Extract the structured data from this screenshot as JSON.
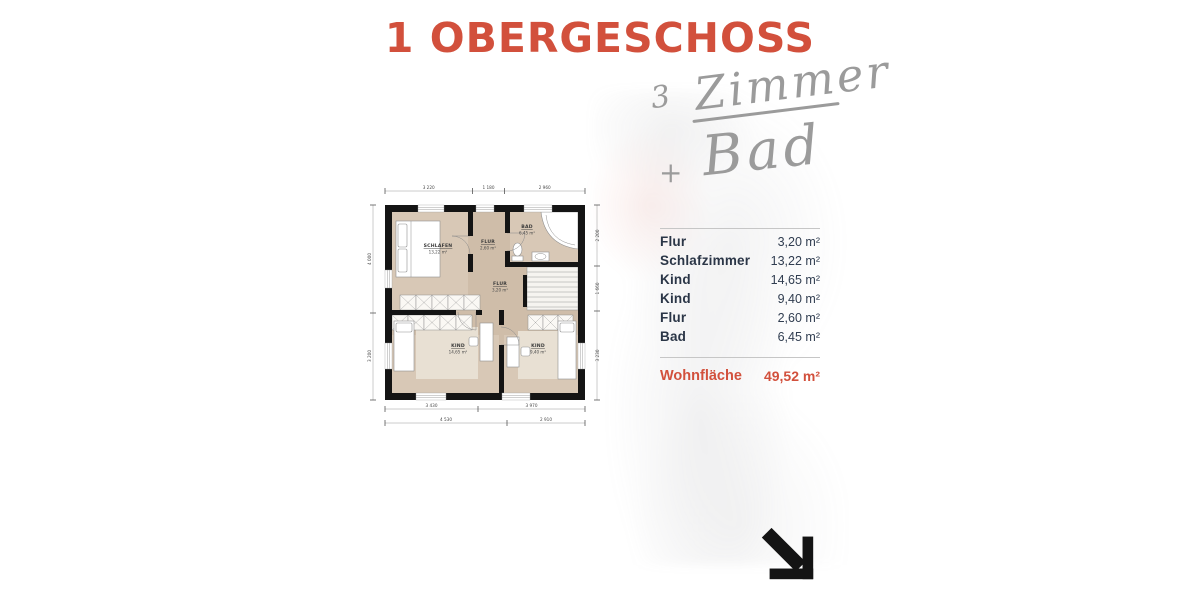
{
  "page": {
    "title": "1 OBERGESCHOSS"
  },
  "handwriting": {
    "count": "3",
    "word1": "Zimmer",
    "plus": "+",
    "word2": "Bad"
  },
  "plan": {
    "rooms": {
      "schlafen": {
        "name": "SCHLAFEN",
        "area": "13,22 m²"
      },
      "flur_klein": {
        "name": "FLUR",
        "area": "2,60 m²"
      },
      "bad": {
        "name": "BAD",
        "area": "6,45 m²"
      },
      "flur": {
        "name": "FLUR",
        "area": "3,20 m²"
      },
      "kind_links": {
        "name": "KIND",
        "area": "14,65 m²"
      },
      "kind_rechts": {
        "name": "KIND",
        "area": "9,40 m²"
      }
    },
    "dims": {
      "top": [
        "3 220",
        "1 180",
        "2 960"
      ],
      "bottom_inner": [
        "3 430",
        "3 970"
      ],
      "bottom_outer": [
        "4 530",
        "2 910"
      ],
      "left": [
        "4 000",
        "3 200"
      ],
      "right": [
        "2 200",
        "1 660",
        "3 230"
      ]
    }
  },
  "table": {
    "rows": [
      {
        "label": "Flur",
        "value": "3,20 m²"
      },
      {
        "label": "Schlafzimmer",
        "value": "13,22 m²"
      },
      {
        "label": "Kind",
        "value": "14,65 m²"
      },
      {
        "label": "Kind",
        "value": "9,40 m²"
      },
      {
        "label": "Flur",
        "value": "2,60 m²"
      },
      {
        "label": "Bad",
        "value": "6,45 m²"
      }
    ],
    "total": {
      "label": "Wohnfläche",
      "value": "49,52 m²"
    }
  },
  "colors": {
    "accent": "#d2503c",
    "navy": "#2b3647",
    "hand_gray": "#9b9b9b"
  }
}
